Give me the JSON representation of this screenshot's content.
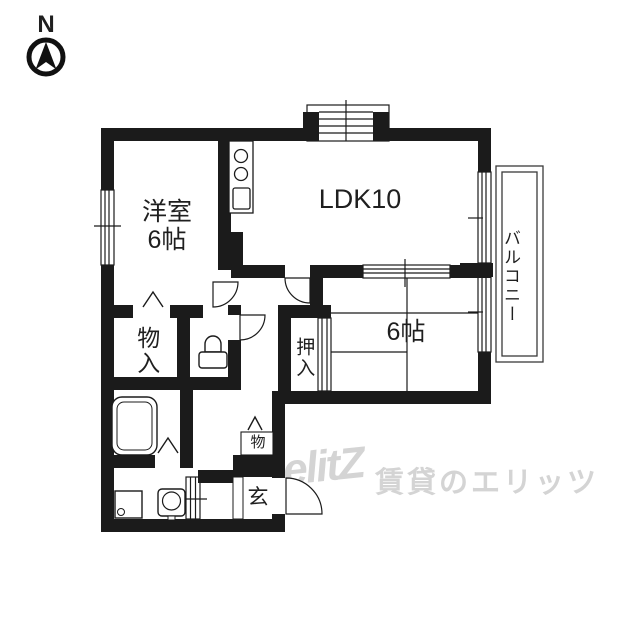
{
  "compass": {
    "label": "N"
  },
  "rooms": {
    "western_room": {
      "label": "洋室\n6帖"
    },
    "ldk": {
      "label": "LDK10"
    },
    "balcony": {
      "label": "バルコニー"
    },
    "tatami_room": {
      "label": "6帖"
    },
    "oshiire": {
      "label": "押入"
    },
    "storage": {
      "label": "物入"
    },
    "small_storage": {
      "label": "物"
    },
    "entrance": {
      "label": "玄"
    }
  },
  "watermark": {
    "logo": "elitZ",
    "text": "賃貸のエリッツ"
  },
  "colors": {
    "wall": "#1b1b1b",
    "background": "#ffffff",
    "watermark": "#d4d4d4"
  }
}
